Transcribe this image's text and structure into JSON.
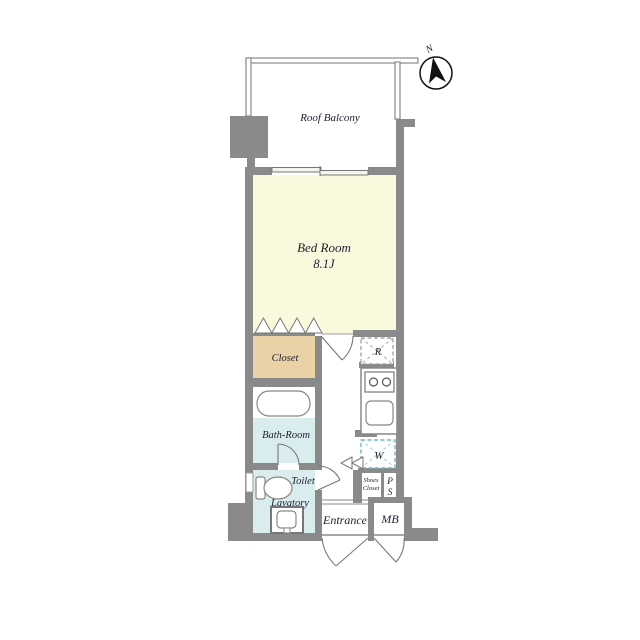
{
  "plan": {
    "type": "apartment-floor-plan",
    "compass": {
      "north_label": "N"
    },
    "rooms": {
      "roof_balcony": {
        "label": "Roof Balcony"
      },
      "bedroom": {
        "label": "Bed Room",
        "size": "8.1J"
      },
      "closet": {
        "label": "Closet"
      },
      "bathroom": {
        "label": "Bath-Room"
      },
      "toilet": {
        "label": "Toilet"
      },
      "lavatory": {
        "label": "Lavatory"
      },
      "entrance": {
        "label": "Entrance"
      },
      "meter_box": {
        "label": "MB"
      },
      "shoes_closet": {
        "label_line1": "Shoes",
        "label_line2": "Closet"
      },
      "pipe_space": {
        "label_line1": "P",
        "label_line2": "S"
      },
      "refrigerator_space": {
        "label": "R"
      },
      "washer_space": {
        "label": "W"
      }
    },
    "colors": {
      "wall": "#8a8a8a",
      "bedroom_fill": "#fbf9dd",
      "closet_fill": "#e9d2a6",
      "wet_area_fill": "#daedee",
      "washer_dash": "#6fb5bd",
      "text": "#1e1e32",
      "background": "#ffffff"
    }
  }
}
